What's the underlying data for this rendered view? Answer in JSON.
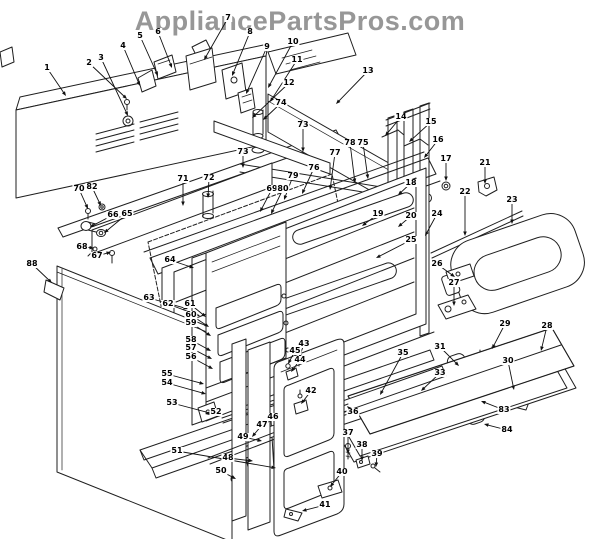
{
  "watermark": "AppliancePartsPros.com",
  "diagram": {
    "type": "exploded-parts-diagram",
    "description": "Range / oven body exploded parts view with numbered callouts",
    "callouts": [
      {
        "n": "1",
        "x": 47,
        "y": 68,
        "tx": 66,
        "ty": 96
      },
      {
        "n": "2",
        "x": 89,
        "y": 63,
        "tx": 127,
        "ty": 99
      },
      {
        "n": "3",
        "x": 101,
        "y": 58,
        "tx": 128,
        "ty": 116
      },
      {
        "n": "4",
        "x": 123,
        "y": 46,
        "tx": 140,
        "ty": 86
      },
      {
        "n": "5",
        "x": 140,
        "y": 36,
        "tx": 158,
        "ty": 76
      },
      {
        "n": "6",
        "x": 158,
        "y": 32,
        "tx": 172,
        "ty": 68
      },
      {
        "n": "7",
        "x": 228,
        "y": 18,
        "tx": 204,
        "ty": 60
      },
      {
        "n": "8",
        "x": 250,
        "y": 32,
        "tx": 232,
        "ty": 76
      },
      {
        "n": "9",
        "x": 267,
        "y": 47,
        "tx": 246,
        "ty": 94
      },
      {
        "n": "10",
        "x": 293,
        "y": 42,
        "tx": 268,
        "ty": 88
      },
      {
        "n": "11",
        "x": 297,
        "y": 60,
        "tx": 270,
        "ty": 102
      },
      {
        "n": "12",
        "x": 289,
        "y": 83,
        "tx": 252,
        "ty": 118
      },
      {
        "n": "13",
        "x": 368,
        "y": 71,
        "tx": 336,
        "ty": 104
      },
      {
        "n": "74",
        "x": 281,
        "y": 103,
        "tx": 263,
        "ty": 120
      },
      {
        "n": "73",
        "x": 303,
        "y": 125,
        "tx": 303,
        "ty": 152
      },
      {
        "n": "73",
        "x": 243,
        "y": 152,
        "tx": 243,
        "ty": 168
      },
      {
        "n": "71",
        "x": 183,
        "y": 179,
        "tx": 183,
        "ty": 206
      },
      {
        "n": "72",
        "x": 209,
        "y": 178,
        "tx": 208,
        "ty": 198
      },
      {
        "n": "70",
        "x": 79,
        "y": 189,
        "tx": 88,
        "ty": 209
      },
      {
        "n": "82",
        "x": 92,
        "y": 187,
        "tx": 101,
        "ty": 206
      },
      {
        "n": "66",
        "x": 113,
        "y": 215,
        "tx": 90,
        "ty": 227
      },
      {
        "n": "65",
        "x": 127,
        "y": 214,
        "tx": 104,
        "ty": 233
      },
      {
        "n": "68",
        "x": 82,
        "y": 247,
        "tx": 94,
        "ty": 248
      },
      {
        "n": "67",
        "x": 97,
        "y": 256,
        "tx": 111,
        "ty": 252
      },
      {
        "n": "88",
        "x": 32,
        "y": 264,
        "tx": 52,
        "ty": 283
      },
      {
        "n": "64",
        "x": 170,
        "y": 260,
        "tx": 194,
        "ty": 268
      },
      {
        "n": "69",
        "x": 272,
        "y": 189,
        "tx": 260,
        "ty": 212
      },
      {
        "n": "80",
        "x": 283,
        "y": 189,
        "tx": 271,
        "ty": 214
      },
      {
        "n": "79",
        "x": 293,
        "y": 176,
        "tx": 284,
        "ty": 200
      },
      {
        "n": "76",
        "x": 314,
        "y": 168,
        "tx": 302,
        "ty": 194
      },
      {
        "n": "77",
        "x": 335,
        "y": 153,
        "tx": 330,
        "ty": 190
      },
      {
        "n": "78",
        "x": 350,
        "y": 143,
        "tx": 355,
        "ty": 183
      },
      {
        "n": "75",
        "x": 363,
        "y": 143,
        "tx": 368,
        "ty": 179
      },
      {
        "n": "14",
        "x": 401,
        "y": 117,
        "tx": 385,
        "ty": 136
      },
      {
        "n": "15",
        "x": 431,
        "y": 122,
        "tx": 409,
        "ty": 142
      },
      {
        "n": "16",
        "x": 438,
        "y": 140,
        "tx": 424,
        "ty": 158
      },
      {
        "n": "17",
        "x": 446,
        "y": 159,
        "tx": 446,
        "ty": 181
      },
      {
        "n": "18",
        "x": 411,
        "y": 183,
        "tx": 398,
        "ty": 195
      },
      {
        "n": "19",
        "x": 378,
        "y": 214,
        "tx": 362,
        "ty": 226
      },
      {
        "n": "20",
        "x": 411,
        "y": 216,
        "tx": 398,
        "ty": 227
      },
      {
        "n": "21",
        "x": 485,
        "y": 163,
        "tx": 485,
        "ty": 184
      },
      {
        "n": "22",
        "x": 465,
        "y": 192,
        "tx": 465,
        "ty": 236
      },
      {
        "n": "23",
        "x": 512,
        "y": 200,
        "tx": 512,
        "ty": 224
      },
      {
        "n": "24",
        "x": 437,
        "y": 214,
        "tx": 425,
        "ty": 236
      },
      {
        "n": "25",
        "x": 411,
        "y": 240,
        "tx": 376,
        "ty": 258
      },
      {
        "n": "26",
        "x": 437,
        "y": 264,
        "tx": 455,
        "ty": 277
      },
      {
        "n": "27",
        "x": 454,
        "y": 283,
        "tx": 454,
        "ty": 306
      },
      {
        "n": "28",
        "x": 547,
        "y": 326,
        "tx": 541,
        "ty": 351
      },
      {
        "n": "29",
        "x": 505,
        "y": 324,
        "tx": 492,
        "ty": 349
      },
      {
        "n": "30",
        "x": 508,
        "y": 361,
        "tx": 514,
        "ty": 390
      },
      {
        "n": "31",
        "x": 440,
        "y": 347,
        "tx": 459,
        "ty": 366
      },
      {
        "n": "33",
        "x": 440,
        "y": 373,
        "tx": 421,
        "ty": 391
      },
      {
        "n": "35",
        "x": 403,
        "y": 353,
        "tx": 380,
        "ty": 395
      },
      {
        "n": "83",
        "x": 504,
        "y": 410,
        "tx": 481,
        "ty": 401
      },
      {
        "n": "84",
        "x": 507,
        "y": 430,
        "tx": 484,
        "ty": 424
      },
      {
        "n": "36",
        "x": 353,
        "y": 412,
        "tx": 347,
        "ty": 406
      },
      {
        "n": "37",
        "x": 348,
        "y": 433,
        "tx": 348,
        "ty": 454
      },
      {
        "n": "38",
        "x": 362,
        "y": 445,
        "tx": 362,
        "ty": 461
      },
      {
        "n": "39",
        "x": 377,
        "y": 454,
        "tx": 376,
        "ty": 467
      },
      {
        "n": "40",
        "x": 342,
        "y": 472,
        "tx": 330,
        "ty": 487
      },
      {
        "n": "41",
        "x": 325,
        "y": 505,
        "tx": 302,
        "ty": 511
      },
      {
        "n": "42",
        "x": 311,
        "y": 391,
        "tx": 301,
        "ty": 404
      },
      {
        "n": "43",
        "x": 304,
        "y": 344,
        "tx": 299,
        "ty": 358
      },
      {
        "n": "45",
        "x": 295,
        "y": 351,
        "tx": 288,
        "ty": 364
      },
      {
        "n": "44",
        "x": 300,
        "y": 360,
        "tx": 291,
        "ty": 372
      },
      {
        "n": "46",
        "x": 273,
        "y": 417,
        "tx": 262,
        "ty": 429
      },
      {
        "n": "47",
        "x": 262,
        "y": 425,
        "tx": 252,
        "ty": 437
      },
      {
        "n": "63",
        "x": 149,
        "y": 298,
        "tx": 188,
        "ty": 309
      },
      {
        "n": "62",
        "x": 168,
        "y": 304,
        "tx": 200,
        "ty": 316
      },
      {
        "n": "61",
        "x": 190,
        "y": 304,
        "tx": 206,
        "ty": 317
      },
      {
        "n": "60",
        "x": 191,
        "y": 315,
        "tx": 209,
        "ty": 327
      },
      {
        "n": "59",
        "x": 191,
        "y": 323,
        "tx": 211,
        "ty": 336
      },
      {
        "n": "58",
        "x": 191,
        "y": 340,
        "tx": 211,
        "ty": 351
      },
      {
        "n": "57",
        "x": 191,
        "y": 348,
        "tx": 212,
        "ty": 359
      },
      {
        "n": "56",
        "x": 191,
        "y": 357,
        "tx": 213,
        "ty": 369
      },
      {
        "n": "55",
        "x": 167,
        "y": 374,
        "tx": 204,
        "ty": 384
      },
      {
        "n": "54",
        "x": 167,
        "y": 383,
        "tx": 206,
        "ty": 394
      },
      {
        "n": "53",
        "x": 172,
        "y": 403,
        "tx": 221,
        "ty": 416
      },
      {
        "n": "52",
        "x": 216,
        "y": 412,
        "tx": 205,
        "ty": 414
      },
      {
        "n": "51",
        "x": 177,
        "y": 451,
        "tx": 276,
        "ty": 468
      },
      {
        "n": "49",
        "x": 243,
        "y": 437,
        "tx": 262,
        "ty": 441
      },
      {
        "n": "48",
        "x": 228,
        "y": 458,
        "tx": 253,
        "ty": 461
      },
      {
        "n": "50",
        "x": 221,
        "y": 471,
        "tx": 236,
        "ty": 479
      }
    ]
  }
}
